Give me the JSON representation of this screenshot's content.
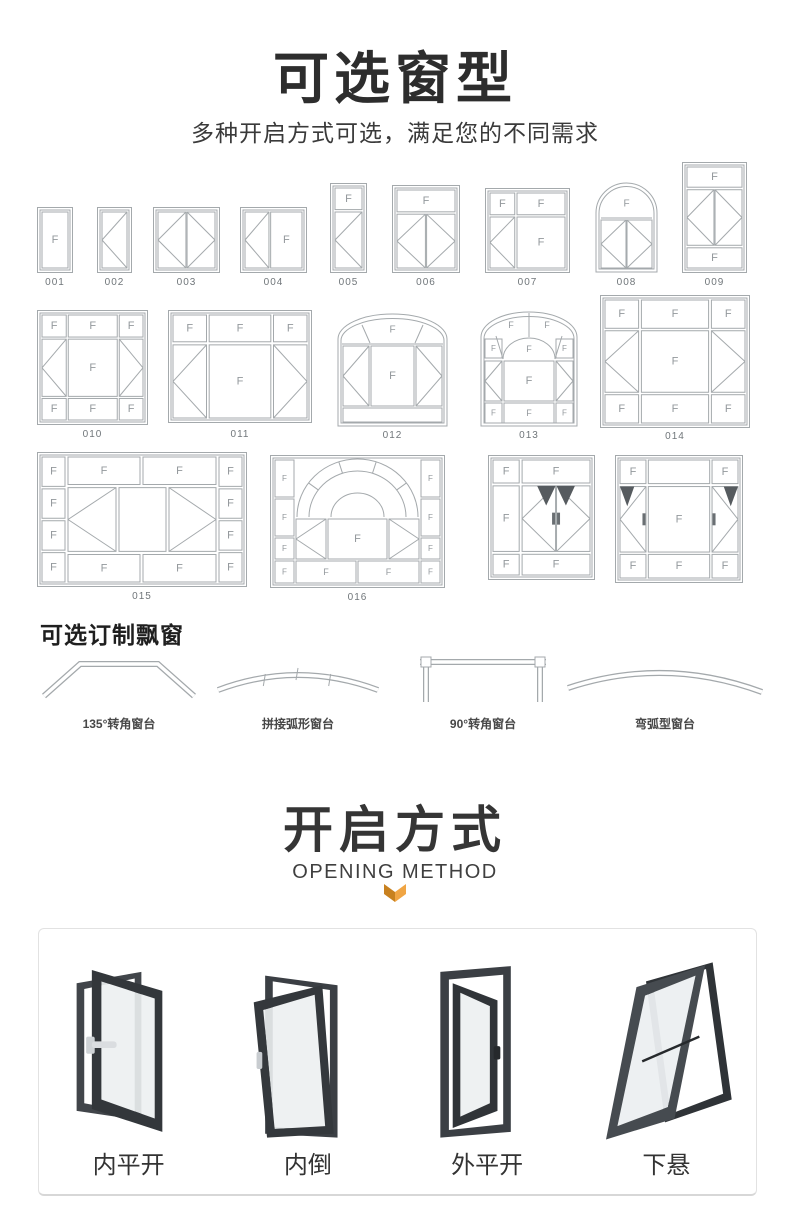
{
  "header": {
    "title": "可选窗型",
    "subtitle": "多种开启方式可选，满足您的不同需求"
  },
  "pane_letter": "F",
  "colors": {
    "diagram_line": "#a4a9ac",
    "pane_letter": "#93989c",
    "code_text": "#70767a",
    "heading_text": "#2d2d2d",
    "accent_orange": "#f0a544",
    "accent_orange_dark": "#c8811f",
    "photo_frame_dark": "#3b3f44"
  },
  "window_types": {
    "items": [
      {
        "code": "001",
        "x": 37,
        "y": 207,
        "w": 36,
        "h": 66,
        "ly": 277,
        "panes": [
          {
            "t": "F",
            "x": 0,
            "y": 0,
            "w": 1,
            "h": 1
          }
        ]
      },
      {
        "code": "002",
        "x": 97,
        "y": 207,
        "w": 35,
        "h": 66,
        "ly": 277,
        "panes": [
          {
            "t": "CL",
            "x": 0,
            "y": 0,
            "w": 1,
            "h": 1
          }
        ]
      },
      {
        "code": "003",
        "x": 153,
        "y": 207,
        "w": 67,
        "h": 66,
        "ly": 277,
        "panes": [
          {
            "t": "CL",
            "x": 0,
            "y": 0,
            "w": 0.49,
            "h": 1
          },
          {
            "t": "CR",
            "x": 0.51,
            "y": 0,
            "w": 0.49,
            "h": 1
          }
        ]
      },
      {
        "code": "004",
        "x": 240,
        "y": 207,
        "w": 67,
        "h": 66,
        "ly": 277,
        "panes": [
          {
            "t": "CL",
            "x": 0,
            "y": 0,
            "w": 0.42,
            "h": 1
          },
          {
            "t": "F",
            "x": 0.45,
            "y": 0,
            "w": 0.55,
            "h": 1
          }
        ]
      },
      {
        "code": "005",
        "x": 330,
        "y": 183,
        "w": 37,
        "h": 90,
        "ly": 277,
        "panes": [
          {
            "t": "F",
            "x": 0,
            "y": 0,
            "w": 1,
            "h": 0.27
          },
          {
            "t": "CL",
            "x": 0,
            "y": 0.3,
            "w": 1,
            "h": 0.7
          }
        ]
      },
      {
        "code": "006",
        "x": 392,
        "y": 185,
        "w": 68,
        "h": 88,
        "ly": 277,
        "panes": [
          {
            "t": "F",
            "x": 0,
            "y": 0,
            "w": 1,
            "h": 0.28
          },
          {
            "t": "CL",
            "x": 0,
            "y": 0.31,
            "w": 0.49,
            "h": 0.69
          },
          {
            "t": "CR",
            "x": 0.51,
            "y": 0.31,
            "w": 0.49,
            "h": 0.69
          }
        ]
      },
      {
        "code": "007",
        "x": 485,
        "y": 188,
        "w": 85,
        "h": 85,
        "ly": 277,
        "panes": [
          {
            "t": "F",
            "x": 0,
            "y": 0,
            "w": 0.33,
            "h": 0.29
          },
          {
            "t": "F",
            "x": 0.36,
            "y": 0,
            "w": 0.64,
            "h": 0.29
          },
          {
            "t": "CL",
            "x": 0,
            "y": 0.32,
            "w": 0.33,
            "h": 0.68
          },
          {
            "t": "F",
            "x": 0.36,
            "y": 0.32,
            "w": 0.64,
            "h": 0.68
          }
        ]
      },
      {
        "code": "008",
        "x": 595,
        "y": 182,
        "w": 63,
        "h": 91,
        "ly": 277,
        "custom": "arch8"
      },
      {
        "code": "009",
        "x": 682,
        "y": 162,
        "w": 65,
        "h": 111,
        "ly": 277,
        "panes": [
          {
            "t": "F",
            "x": 0,
            "y": 0,
            "w": 1,
            "h": 0.2
          },
          {
            "t": "CL",
            "x": 0,
            "y": 0.225,
            "w": 0.49,
            "h": 0.55
          },
          {
            "t": "CR",
            "x": 0.51,
            "y": 0.225,
            "w": 0.49,
            "h": 0.55
          },
          {
            "t": "F",
            "x": 0,
            "y": 0.8,
            "w": 1,
            "h": 0.2
          }
        ]
      },
      {
        "code": "010",
        "x": 37,
        "y": 310,
        "w": 111,
        "h": 115,
        "ly": 429,
        "panes": [
          {
            "t": "F",
            "x": 0,
            "y": 0,
            "w": 0.24,
            "h": 0.21
          },
          {
            "t": "F",
            "x": 0.26,
            "y": 0,
            "w": 0.485,
            "h": 0.21
          },
          {
            "t": "F",
            "x": 0.765,
            "y": 0,
            "w": 0.235,
            "h": 0.21
          },
          {
            "t": "CL",
            "x": 0,
            "y": 0.23,
            "w": 0.24,
            "h": 0.545
          },
          {
            "t": "F",
            "x": 0.26,
            "y": 0.23,
            "w": 0.485,
            "h": 0.545
          },
          {
            "t": "CR",
            "x": 0.765,
            "y": 0.23,
            "w": 0.235,
            "h": 0.545
          },
          {
            "t": "F",
            "x": 0,
            "y": 0.795,
            "w": 0.24,
            "h": 0.205
          },
          {
            "t": "F",
            "x": 0.26,
            "y": 0.795,
            "w": 0.485,
            "h": 0.205
          },
          {
            "t": "F",
            "x": 0.765,
            "y": 0.795,
            "w": 0.235,
            "h": 0.205
          }
        ]
      },
      {
        "code": "011",
        "x": 168,
        "y": 310,
        "w": 144,
        "h": 113,
        "ly": 429,
        "panes": [
          {
            "t": "F",
            "x": 0,
            "y": 0,
            "w": 0.25,
            "h": 0.26
          },
          {
            "t": "F",
            "x": 0.27,
            "y": 0,
            "w": 0.46,
            "h": 0.26
          },
          {
            "t": "F",
            "x": 0.75,
            "y": 0,
            "w": 0.25,
            "h": 0.26
          },
          {
            "t": "CL",
            "x": 0,
            "y": 0.29,
            "w": 0.25,
            "h": 0.71
          },
          {
            "t": "F",
            "x": 0.27,
            "y": 0.29,
            "w": 0.46,
            "h": 0.71
          },
          {
            "t": "CR",
            "x": 0.75,
            "y": 0.29,
            "w": 0.25,
            "h": 0.71
          }
        ]
      },
      {
        "code": "012",
        "x": 337,
        "y": 312,
        "w": 111,
        "h": 115,
        "ly": 430,
        "custom": "arch12"
      },
      {
        "code": "013",
        "x": 480,
        "y": 310,
        "w": 98,
        "h": 117,
        "ly": 430,
        "custom": "arch13"
      },
      {
        "code": "014",
        "x": 600,
        "y": 295,
        "w": 150,
        "h": 133,
        "ly": 431,
        "panes": [
          {
            "t": "F",
            "x": 0,
            "y": 0,
            "w": 0.24,
            "h": 0.23
          },
          {
            "t": "F",
            "x": 0.26,
            "y": 0,
            "w": 0.48,
            "h": 0.23
          },
          {
            "t": "F",
            "x": 0.76,
            "y": 0,
            "w": 0.24,
            "h": 0.23
          },
          {
            "t": "CL",
            "x": 0,
            "y": 0.25,
            "w": 0.24,
            "h": 0.5
          },
          {
            "t": "F",
            "x": 0.26,
            "y": 0.25,
            "w": 0.48,
            "h": 0.5
          },
          {
            "t": "CR",
            "x": 0.76,
            "y": 0.25,
            "w": 0.24,
            "h": 0.5
          },
          {
            "t": "F",
            "x": 0,
            "y": 0.77,
            "w": 0.24,
            "h": 0.23
          },
          {
            "t": "F",
            "x": 0.26,
            "y": 0.77,
            "w": 0.48,
            "h": 0.23
          },
          {
            "t": "F",
            "x": 0.76,
            "y": 0.77,
            "w": 0.24,
            "h": 0.23
          }
        ]
      },
      {
        "code": "015",
        "x": 37,
        "y": 452,
        "w": 210,
        "h": 135,
        "ly": 591,
        "panes": [
          {
            "t": "F",
            "x": 0,
            "y": 0,
            "w": 0.115,
            "h": 0.235
          },
          {
            "t": "F",
            "x": 0,
            "y": 0.255,
            "w": 0.115,
            "h": 0.235
          },
          {
            "t": "F",
            "x": 0,
            "y": 0.51,
            "w": 0.115,
            "h": 0.235
          },
          {
            "t": "F",
            "x": 0,
            "y": 0.765,
            "w": 0.115,
            "h": 0.235
          },
          {
            "t": "F",
            "x": 0.885,
            "y": 0,
            "w": 0.115,
            "h": 0.235
          },
          {
            "t": "F",
            "x": 0.885,
            "y": 0.255,
            "w": 0.115,
            "h": 0.235
          },
          {
            "t": "F",
            "x": 0.885,
            "y": 0.51,
            "w": 0.115,
            "h": 0.235
          },
          {
            "t": "F",
            "x": 0.885,
            "y": 0.765,
            "w": 0.115,
            "h": 0.235
          },
          {
            "t": "F",
            "x": 0.13,
            "y": 0,
            "w": 0.36,
            "h": 0.22
          },
          {
            "t": "F",
            "x": 0.505,
            "y": 0,
            "w": 0.365,
            "h": 0.22
          },
          {
            "t": "F",
            "x": 0.13,
            "y": 0.78,
            "w": 0.36,
            "h": 0.22
          },
          {
            "t": "F",
            "x": 0.505,
            "y": 0.78,
            "w": 0.365,
            "h": 0.22
          },
          {
            "t": "CL",
            "x": 0.13,
            "y": 0.245,
            "w": 0.24,
            "h": 0.51
          },
          {
            "t": "E",
            "x": 0.385,
            "y": 0.245,
            "w": 0.235,
            "h": 0.51
          },
          {
            "t": "CR",
            "x": 0.635,
            "y": 0.245,
            "w": 0.235,
            "h": 0.51
          }
        ]
      },
      {
        "code": "016",
        "x": 270,
        "y": 455,
        "w": 175,
        "h": 133,
        "ly": 592,
        "custom": "arch16"
      },
      {
        "code": "",
        "x": 488,
        "y": 455,
        "w": 107,
        "h": 125,
        "ly": 0,
        "panes": [
          {
            "t": "F",
            "x": 0,
            "y": 0,
            "w": 0.27,
            "h": 0.2
          },
          {
            "t": "F",
            "x": 0.3,
            "y": 0,
            "w": 0.7,
            "h": 0.2
          },
          {
            "t": "F",
            "x": 0,
            "y": 0.225,
            "w": 0.27,
            "h": 0.57
          },
          {
            "t": "CLs",
            "x": 0.3,
            "y": 0.225,
            "w": 0.345,
            "h": 0.57
          },
          {
            "t": "CRs",
            "x": 0.655,
            "y": 0.225,
            "w": 0.345,
            "h": 0.57
          },
          {
            "t": "F",
            "x": 0,
            "y": 0.82,
            "w": 0.27,
            "h": 0.18
          },
          {
            "t": "F",
            "x": 0.3,
            "y": 0.82,
            "w": 0.7,
            "h": 0.18
          }
        ]
      },
      {
        "code": "",
        "x": 615,
        "y": 455,
        "w": 128,
        "h": 128,
        "ly": 0,
        "panes": [
          {
            "t": "F",
            "x": 0,
            "y": 0,
            "w": 0.22,
            "h": 0.2
          },
          {
            "t": "E",
            "x": 0.24,
            "y": 0,
            "w": 0.52,
            "h": 0.2
          },
          {
            "t": "F",
            "x": 0.78,
            "y": 0,
            "w": 0.22,
            "h": 0.2
          },
          {
            "t": "CLs2",
            "x": 0,
            "y": 0.225,
            "w": 0.22,
            "h": 0.555
          },
          {
            "t": "F",
            "x": 0.24,
            "y": 0.225,
            "w": 0.52,
            "h": 0.555
          },
          {
            "t": "CRs2",
            "x": 0.78,
            "y": 0.225,
            "w": 0.22,
            "h": 0.555
          },
          {
            "t": "F",
            "x": 0,
            "y": 0.8,
            "w": 0.22,
            "h": 0.2
          },
          {
            "t": "F",
            "x": 0.24,
            "y": 0.8,
            "w": 0.52,
            "h": 0.2
          },
          {
            "t": "F",
            "x": 0.78,
            "y": 0.8,
            "w": 0.22,
            "h": 0.2
          }
        ]
      }
    ]
  },
  "bay": {
    "heading": "可选订制飘窗",
    "items": [
      {
        "label": "135°转角窗台",
        "shape": "corner135",
        "x": 38,
        "w": 162
      },
      {
        "label": "拼接弧形窗台",
        "shape": "segmented-arc",
        "x": 212,
        "w": 172
      },
      {
        "label": "90°转角窗台",
        "shape": "corner90",
        "x": 412,
        "w": 142
      },
      {
        "label": "弯弧型窗台",
        "shape": "curved-arc",
        "x": 562,
        "w": 206
      }
    ]
  },
  "opening": {
    "title": "开启方式",
    "subtitle": "OPENING METHOD",
    "items": [
      {
        "label": "内平开",
        "shape": "inward-casement"
      },
      {
        "label": "内倒",
        "shape": "tilt-in"
      },
      {
        "label": "外平开",
        "shape": "outward-casement"
      },
      {
        "label": "下悬",
        "shape": "bottom-hung"
      }
    ]
  }
}
